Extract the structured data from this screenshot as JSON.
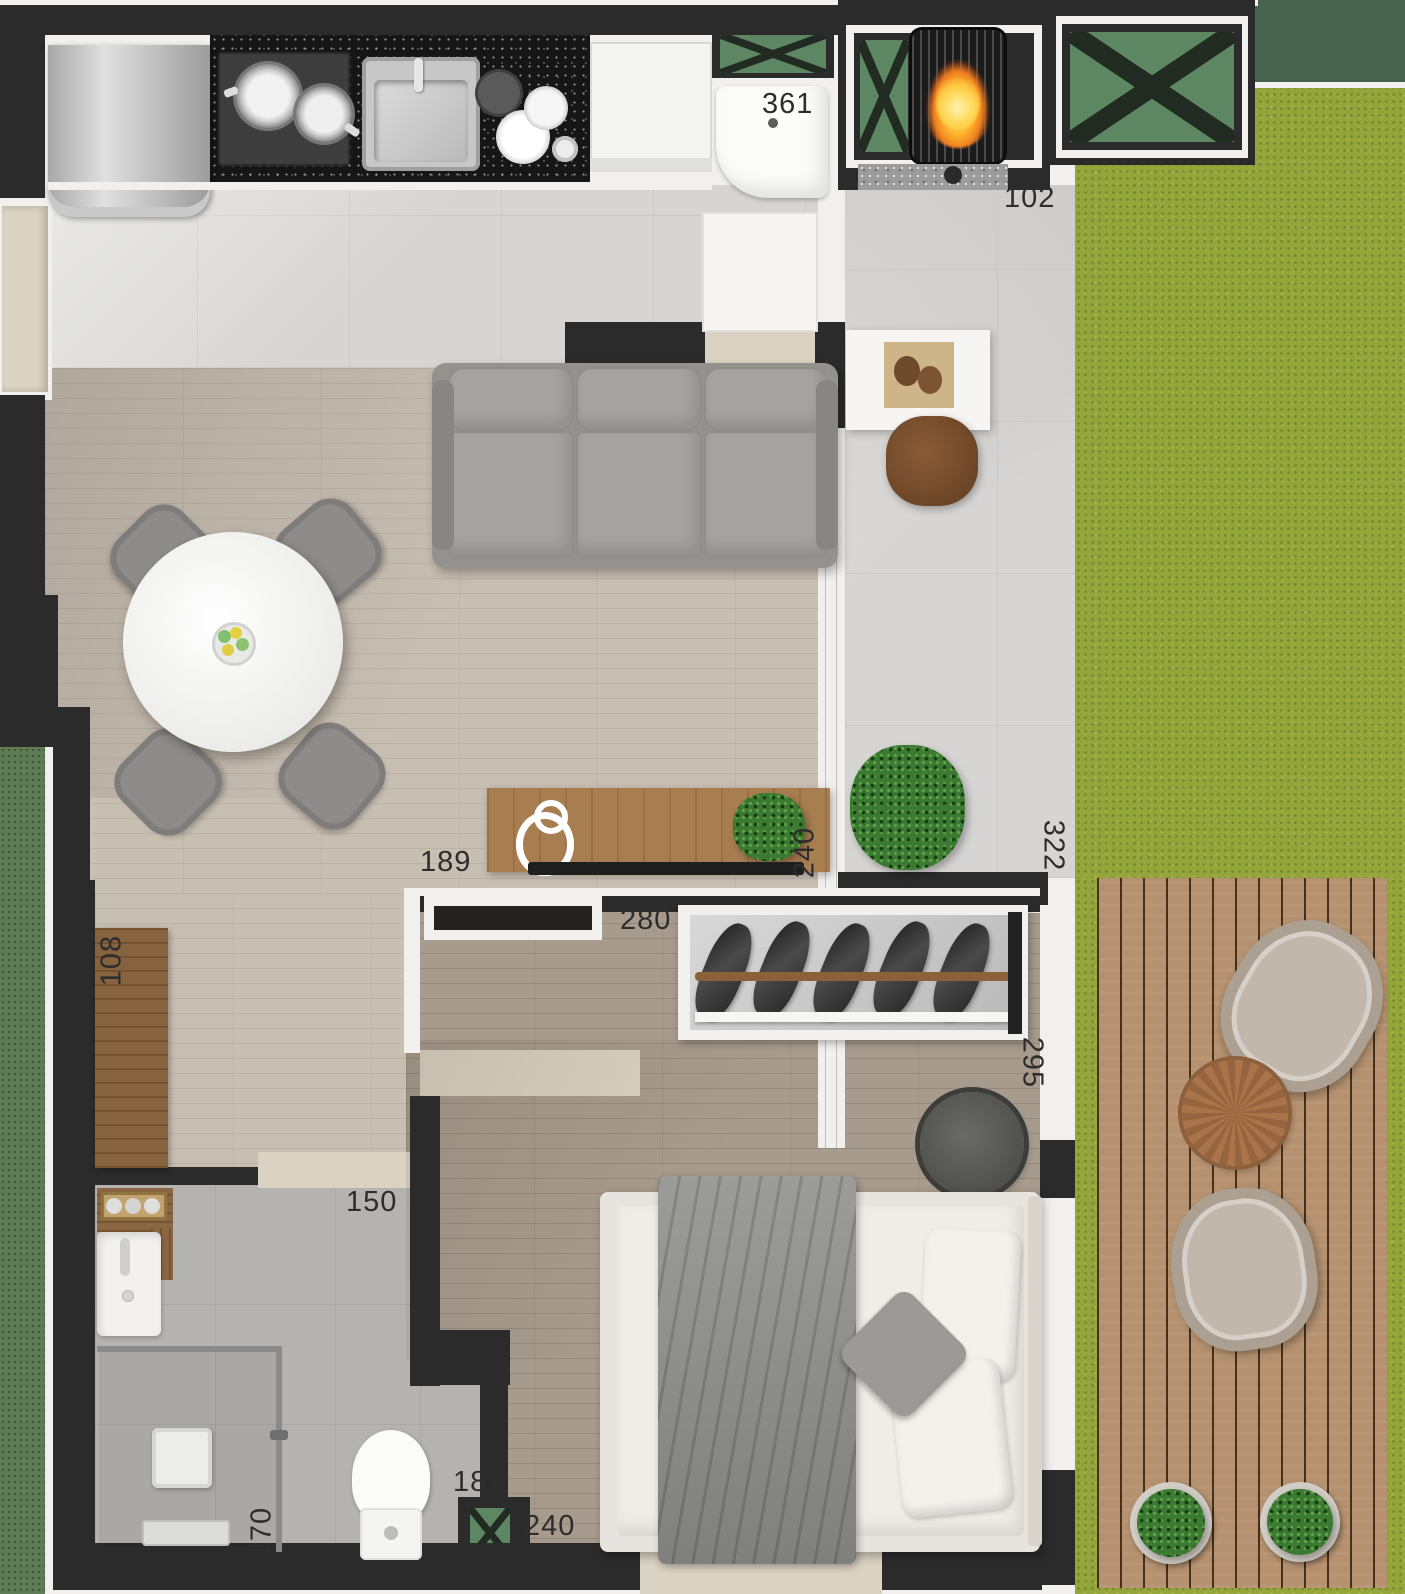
{
  "dimensions": {
    "laundry": "361",
    "terrace_entry": "102",
    "terrace_side": "322",
    "living_terrace_wall": "240",
    "sideboard": "189",
    "bedroom_shelf": "280",
    "bedroom_side": "295",
    "entry_cabinet": "108",
    "bathroom_entry": "150",
    "shower": "170",
    "bathroom_wall": "187",
    "bedroom_window": "240"
  },
  "colors": {
    "wall": "#2b2b2b",
    "trim": "#f1f0ee",
    "duct_green": "#5d8763",
    "planter_green": "#5e7d57",
    "grass": "#94a53c",
    "grass_dark": "#47634d",
    "deck_wood": "#b5916f",
    "wood_living": "#c8bfb3",
    "wood_bedroom": "#a79b8d",
    "tile_light": "#d6d5d3",
    "tile_bath": "#b4b3b1",
    "granite": "#161616",
    "sideboard_wood": "#a87e50",
    "fire_orange": "#ff9a2a",
    "threshold_beige": "#dad3c3",
    "label_ink": "#2d2d2d"
  }
}
